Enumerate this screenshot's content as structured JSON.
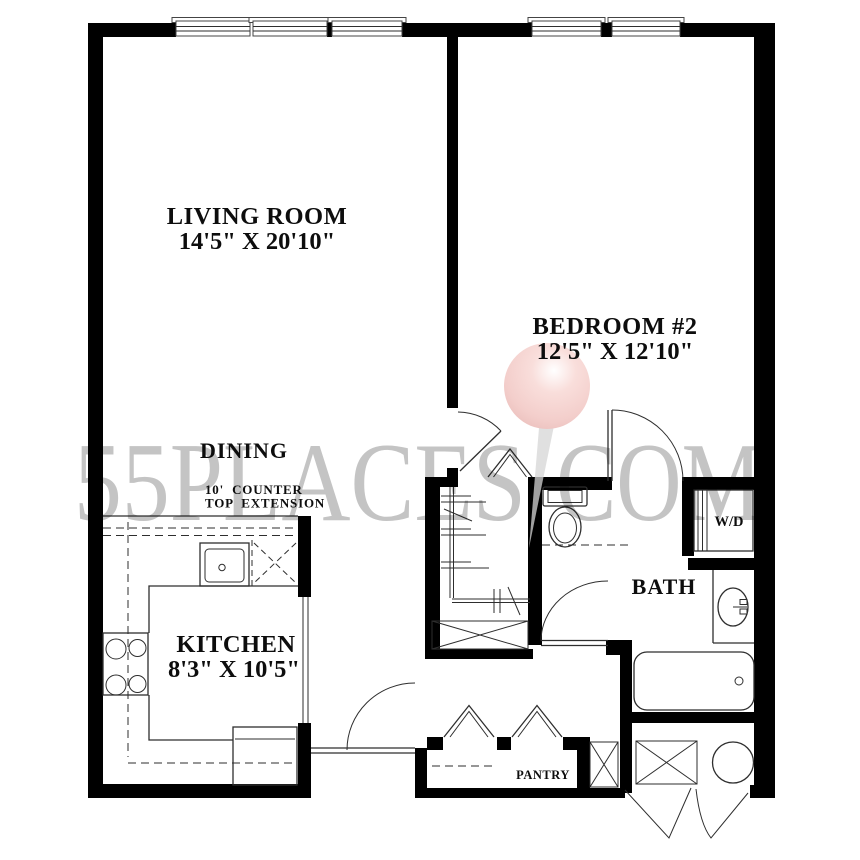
{
  "watermark": {
    "left": "55PLACES",
    "right": "COM"
  },
  "rooms": {
    "living": {
      "name": "LIVING ROOM",
      "dims": "14'5\" X 20'10\""
    },
    "bedroom": {
      "name": "BEDROOM #2",
      "dims": "12'5\" X 12'10\""
    },
    "dining": {
      "name": "DINING",
      "note1": "10'  COUNTER",
      "note2": "TOP  EXTENSION"
    },
    "kitchen": {
      "name": "KITCHEN",
      "dims": "8'3\" X 10'5\""
    },
    "bath": {
      "name": "BATH"
    },
    "laundry": {
      "name": "W/D"
    },
    "pantry": {
      "name": "PANTRY"
    }
  },
  "colors": {
    "wall": "#000000",
    "line": "#2e2e2e",
    "watermark": "#c4c4c4",
    "pin": "#f3cecb",
    "pin_needle": "#d6d6d6",
    "background": "#ffffff"
  }
}
